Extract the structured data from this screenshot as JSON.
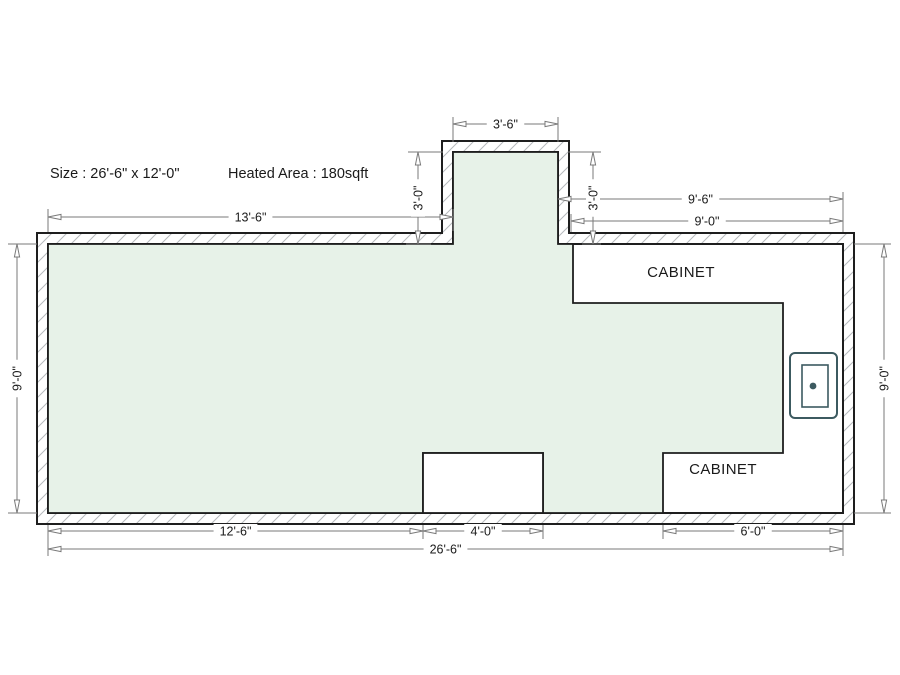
{
  "header": {
    "size_label": "Size : 26'-6\" x 12'-0\"",
    "heated_area_label": "Heated Area : 180sqft"
  },
  "plan": {
    "cabinet_labels": [
      "CABINET",
      "CABINET"
    ],
    "colors": {
      "background": "#ffffff",
      "floor_fill": "#e7f2e8",
      "outline": "#1e1e1e",
      "hatch": "#b6babd",
      "dimension": "#7a7a7a",
      "text": "#1a1a1a",
      "fixture": "#3c5a60"
    },
    "walls": {
      "outer": [
        [
          37,
          233
        ],
        [
          442,
          233
        ],
        [
          442,
          141
        ],
        [
          569,
          141
        ],
        [
          569,
          233
        ],
        [
          854,
          233
        ],
        [
          854,
          524
        ],
        [
          37,
          524
        ]
      ],
      "inner": [
        [
          48,
          244
        ],
        [
          453,
          244
        ],
        [
          453,
          152
        ],
        [
          558,
          152
        ],
        [
          558,
          244
        ],
        [
          843,
          244
        ],
        [
          843,
          513
        ],
        [
          48,
          513
        ]
      ]
    },
    "heated_area_polygon": [
      [
        48,
        244
      ],
      [
        453,
        244
      ],
      [
        453,
        152
      ],
      [
        558,
        152
      ],
      [
        558,
        244
      ],
      [
        573,
        244
      ],
      [
        573,
        303
      ],
      [
        783,
        303
      ],
      [
        783,
        453
      ],
      [
        663,
        453
      ],
      [
        663,
        513
      ],
      [
        543,
        513
      ],
      [
        543,
        453
      ],
      [
        423,
        453
      ],
      [
        423,
        513
      ],
      [
        48,
        513
      ]
    ],
    "floor_opening": {
      "x": 423,
      "y": 453,
      "w": 120,
      "h": 60
    },
    "sink_fixture": {
      "outer": {
        "x": 790,
        "y": 353,
        "w": 47,
        "h": 65,
        "rx": 5
      },
      "inner": {
        "x": 802,
        "y": 365,
        "w": 26,
        "h": 42
      },
      "dot": {
        "cx": 813,
        "cy": 386,
        "r": 3.4
      }
    },
    "extension_lines": [
      [
        453,
        117,
        453,
        142
      ],
      [
        558,
        117,
        558,
        142
      ],
      [
        408,
        152,
        443,
        152
      ],
      [
        406,
        244,
        431,
        244
      ],
      [
        568,
        152,
        601,
        152
      ],
      [
        582,
        244,
        601,
        244
      ],
      [
        48,
        209,
        48,
        232
      ],
      [
        453,
        209,
        453,
        231
      ],
      [
        843,
        192,
        843,
        232
      ],
      [
        571,
        214,
        571,
        232
      ],
      [
        8,
        244,
        37,
        244
      ],
      [
        8,
        513,
        37,
        513
      ],
      [
        854,
        244,
        891,
        244
      ],
      [
        854,
        513,
        891,
        513
      ],
      [
        48,
        525,
        48,
        556
      ],
      [
        423,
        525,
        423,
        539
      ],
      [
        543,
        525,
        543,
        539
      ],
      [
        663,
        525,
        663,
        539
      ],
      [
        843,
        525,
        843,
        556
      ]
    ],
    "dimensions": [
      {
        "label": "3'-6\"",
        "x1": 453,
        "y1": 124,
        "x2": 558,
        "y2": 124
      },
      {
        "label": "13'-6\"",
        "x1": 48,
        "y1": 217,
        "x2": 453,
        "y2": 217
      },
      {
        "label": "9'-6\"",
        "x1": 558,
        "y1": 199,
        "x2": 843,
        "y2": 199
      },
      {
        "label": "9'-0\"",
        "x1": 571,
        "y1": 221,
        "x2": 843,
        "y2": 221
      },
      {
        "label": "3'-0\"",
        "x1": 418,
        "y1": 152,
        "x2": 418,
        "y2": 244
      },
      {
        "label": "3'-0\"",
        "x1": 593,
        "y1": 152,
        "x2": 593,
        "y2": 244
      },
      {
        "label": "9'-0\"",
        "x1": 17,
        "y1": 244,
        "x2": 17,
        "y2": 513
      },
      {
        "label": "9'-0\"",
        "x1": 884,
        "y1": 244,
        "x2": 884,
        "y2": 513
      },
      {
        "label": "12'-6\"",
        "x1": 48,
        "y1": 531,
        "x2": 423,
        "y2": 531
      },
      {
        "label": "4'-0\"",
        "x1": 423,
        "y1": 531,
        "x2": 543,
        "y2": 531
      },
      {
        "label": "6'-0\"",
        "x1": 663,
        "y1": 531,
        "x2": 843,
        "y2": 531
      },
      {
        "label": "26'-6\"",
        "x1": 48,
        "y1": 549,
        "x2": 843,
        "y2": 549
      }
    ]
  }
}
